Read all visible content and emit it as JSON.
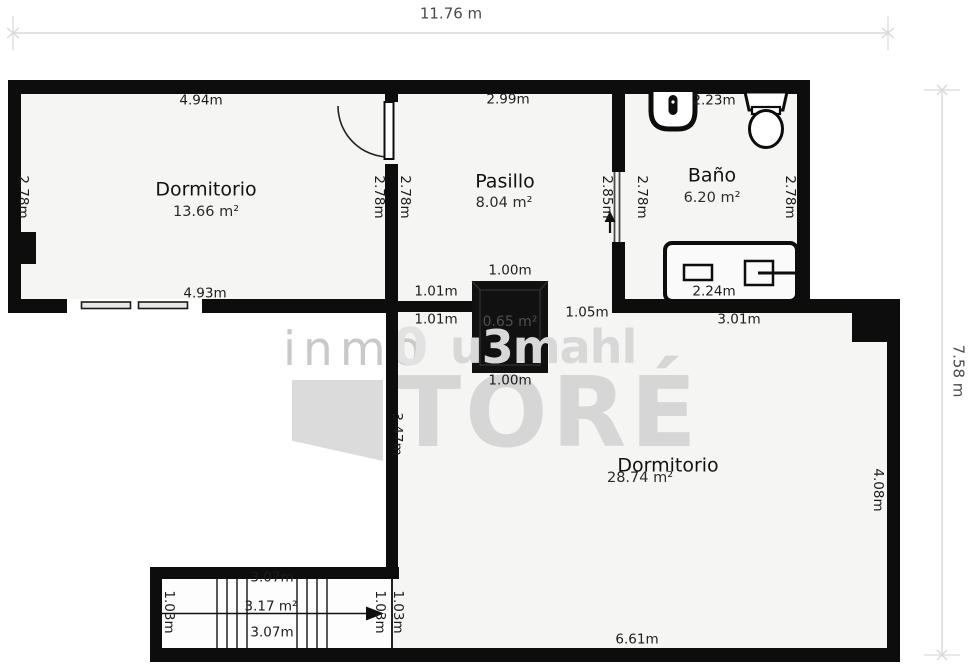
{
  "dimension_lines": {
    "top": "11.76 m",
    "right": "7.58 m"
  },
  "rooms": {
    "dormitorio1": {
      "name": "Dormitorio",
      "area": "13.66 m²",
      "dim_top": "4.94m",
      "dim_bottom": "4.93m",
      "dim_left": "2.78m",
      "dim_right": "2.78m"
    },
    "pasillo": {
      "name": "Pasillo",
      "area": "8.04 m²",
      "dim_top": "2.99m",
      "dim_left": "2.78m",
      "dim_door": "2.85m"
    },
    "bano": {
      "name": "Baño",
      "area": "6.20 m²",
      "dim_top": "2.23m",
      "dim_left": "2.78m",
      "dim_right": "2.78m",
      "dim_tub": "2.24m",
      "dim_bottom": "3.01m"
    },
    "dormitorio2": {
      "name": "Dormitorio",
      "area": "28.74 m²",
      "dim_right": "4.08m",
      "dim_bottom": "6.61m",
      "dim_wall_left": "3.47m",
      "dim_opening": "1.05m"
    },
    "shaft": {
      "area": "0.65 m²",
      "dim_top": "1.00m",
      "dim_bottom": "1.00m",
      "dim_wall_top": "1.01m",
      "dim_wall_bottom": "1.01m"
    },
    "stairs": {
      "area": "3.17 m²",
      "dim_top": "3.07m",
      "dim_bottom": "3.07m",
      "dim_left": "1.03m",
      "dim_right_inner": "1.03m",
      "dim_right_outer": "1.03m"
    }
  },
  "watermark": {
    "part1": "inmo",
    "part2": "0",
    "part3": "u3mahl",
    "part4": "TORÉ"
  },
  "colors": {
    "wall": "#0d0d0d",
    "room_fill": "#f5f5f4",
    "watermark": "#d6d6d6",
    "dim_line": "#d9d9d9"
  }
}
